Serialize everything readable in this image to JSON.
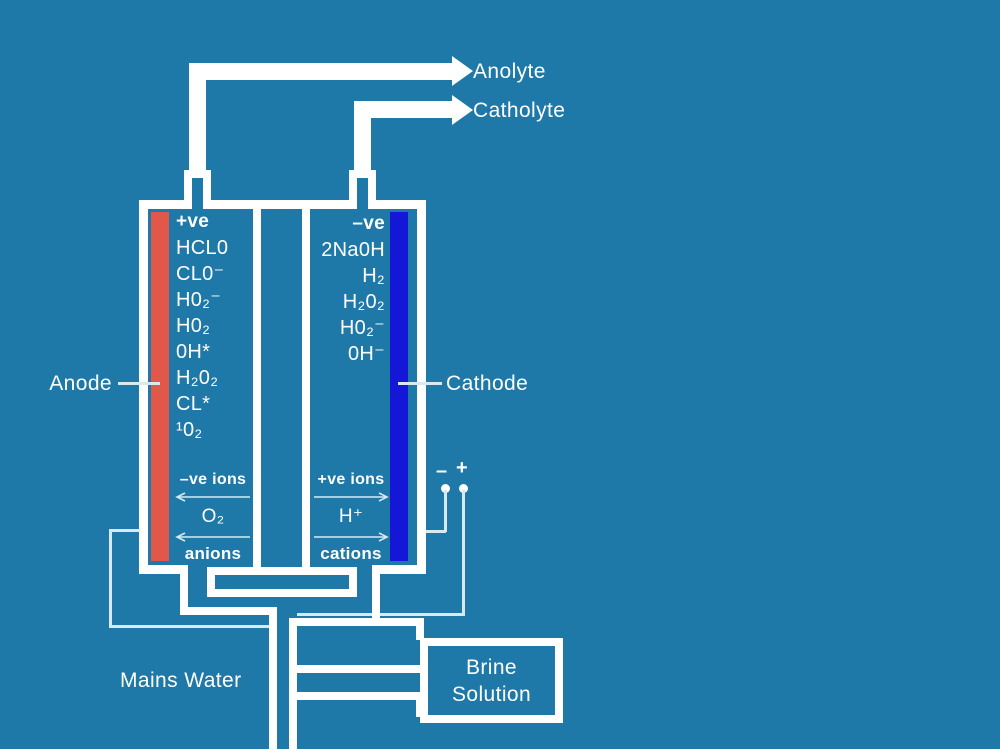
{
  "colors": {
    "background": "#1E78A8",
    "wall_white": "#FFFFFF",
    "anode_red": "#E1584A",
    "cathode_blue": "#1418D6",
    "wire_soft_white": "#D9E9F2"
  },
  "outputs": {
    "anolyte": "Anolyte",
    "catholyte": "Catholyte"
  },
  "electrodes": {
    "anode_label": "Anode",
    "cathode_label": "Cathode",
    "anode_sign": "+ve",
    "cathode_sign": "–ve"
  },
  "anode_species": [
    "HCL0",
    "CL0⁻",
    "H0₂⁻",
    "H0₂",
    "0H*",
    "H₂0₂",
    "CL*",
    "¹0₂"
  ],
  "cathode_species": [
    "2Na0H",
    "H₂",
    "H₂0₂",
    "H0₂⁻",
    "0H⁻"
  ],
  "ion_flow": {
    "anode": {
      "label": "–ve ions",
      "species": "O₂",
      "name": "anions",
      "direction": "left"
    },
    "cathode": {
      "label": "+ve ions",
      "species": "H⁺",
      "name": "cations",
      "direction": "right"
    }
  },
  "terminals": {
    "negative": "–",
    "positive": "+"
  },
  "inlets": {
    "mains_water": "Mains Water",
    "brine_line1": "Brine",
    "brine_line2": "Solution"
  }
}
